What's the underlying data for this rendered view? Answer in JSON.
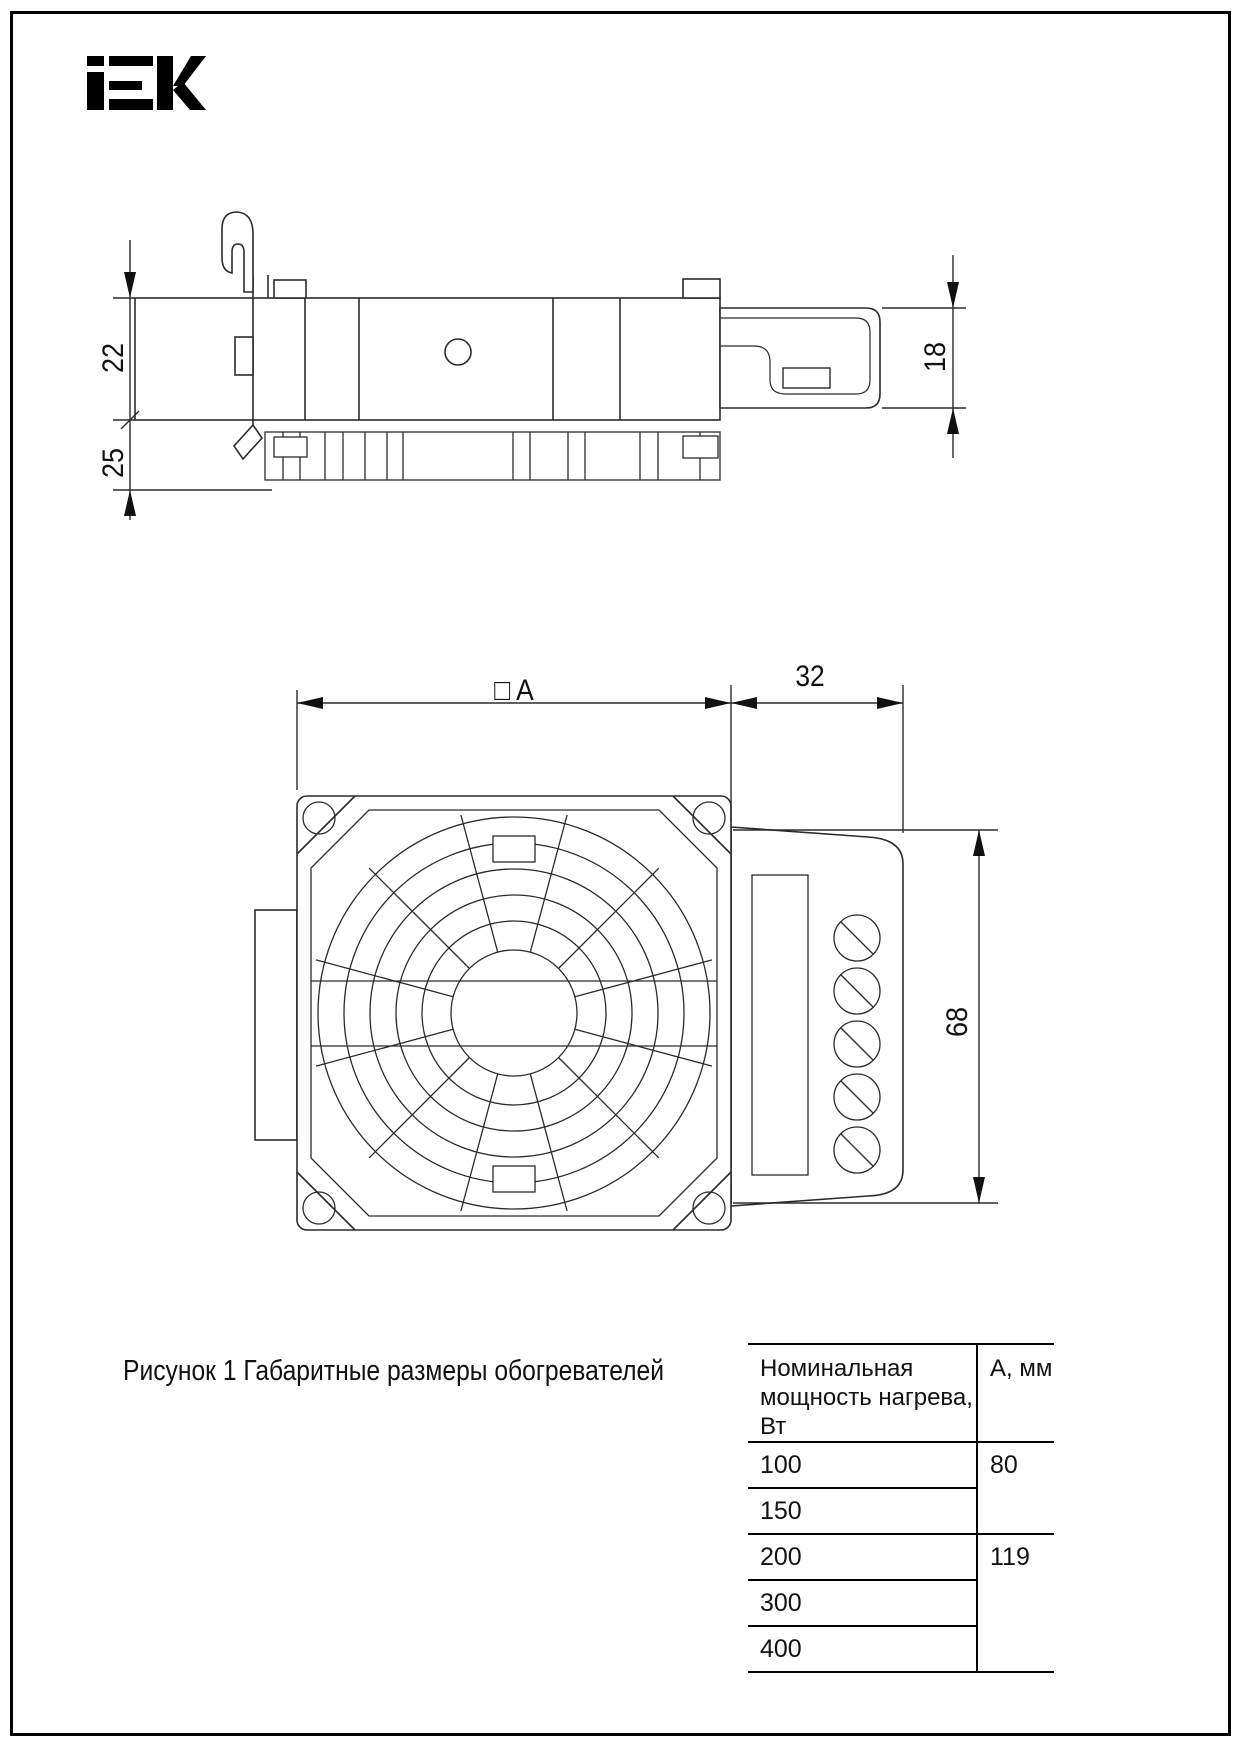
{
  "brand": {
    "logo_text": "IEK"
  },
  "drawing": {
    "dims": {
      "side_upper_height": "22",
      "side_lower_height": "25",
      "side_right_height": "18",
      "front_width_label": "□ A",
      "front_terminal_width": "32",
      "front_height": "68"
    }
  },
  "caption": {
    "text": "Рисунок 1 Габаритные размеры обогревателей"
  },
  "table": {
    "header": {
      "power_line1": "Номинальная",
      "power_line2": "мощность нагрева, Вт",
      "a": "А, мм"
    },
    "rows": [
      {
        "power": "100",
        "a": "80"
      },
      {
        "power": "150"
      },
      {
        "power": "200",
        "a": "119"
      },
      {
        "power": "300"
      },
      {
        "power": "400"
      }
    ]
  }
}
